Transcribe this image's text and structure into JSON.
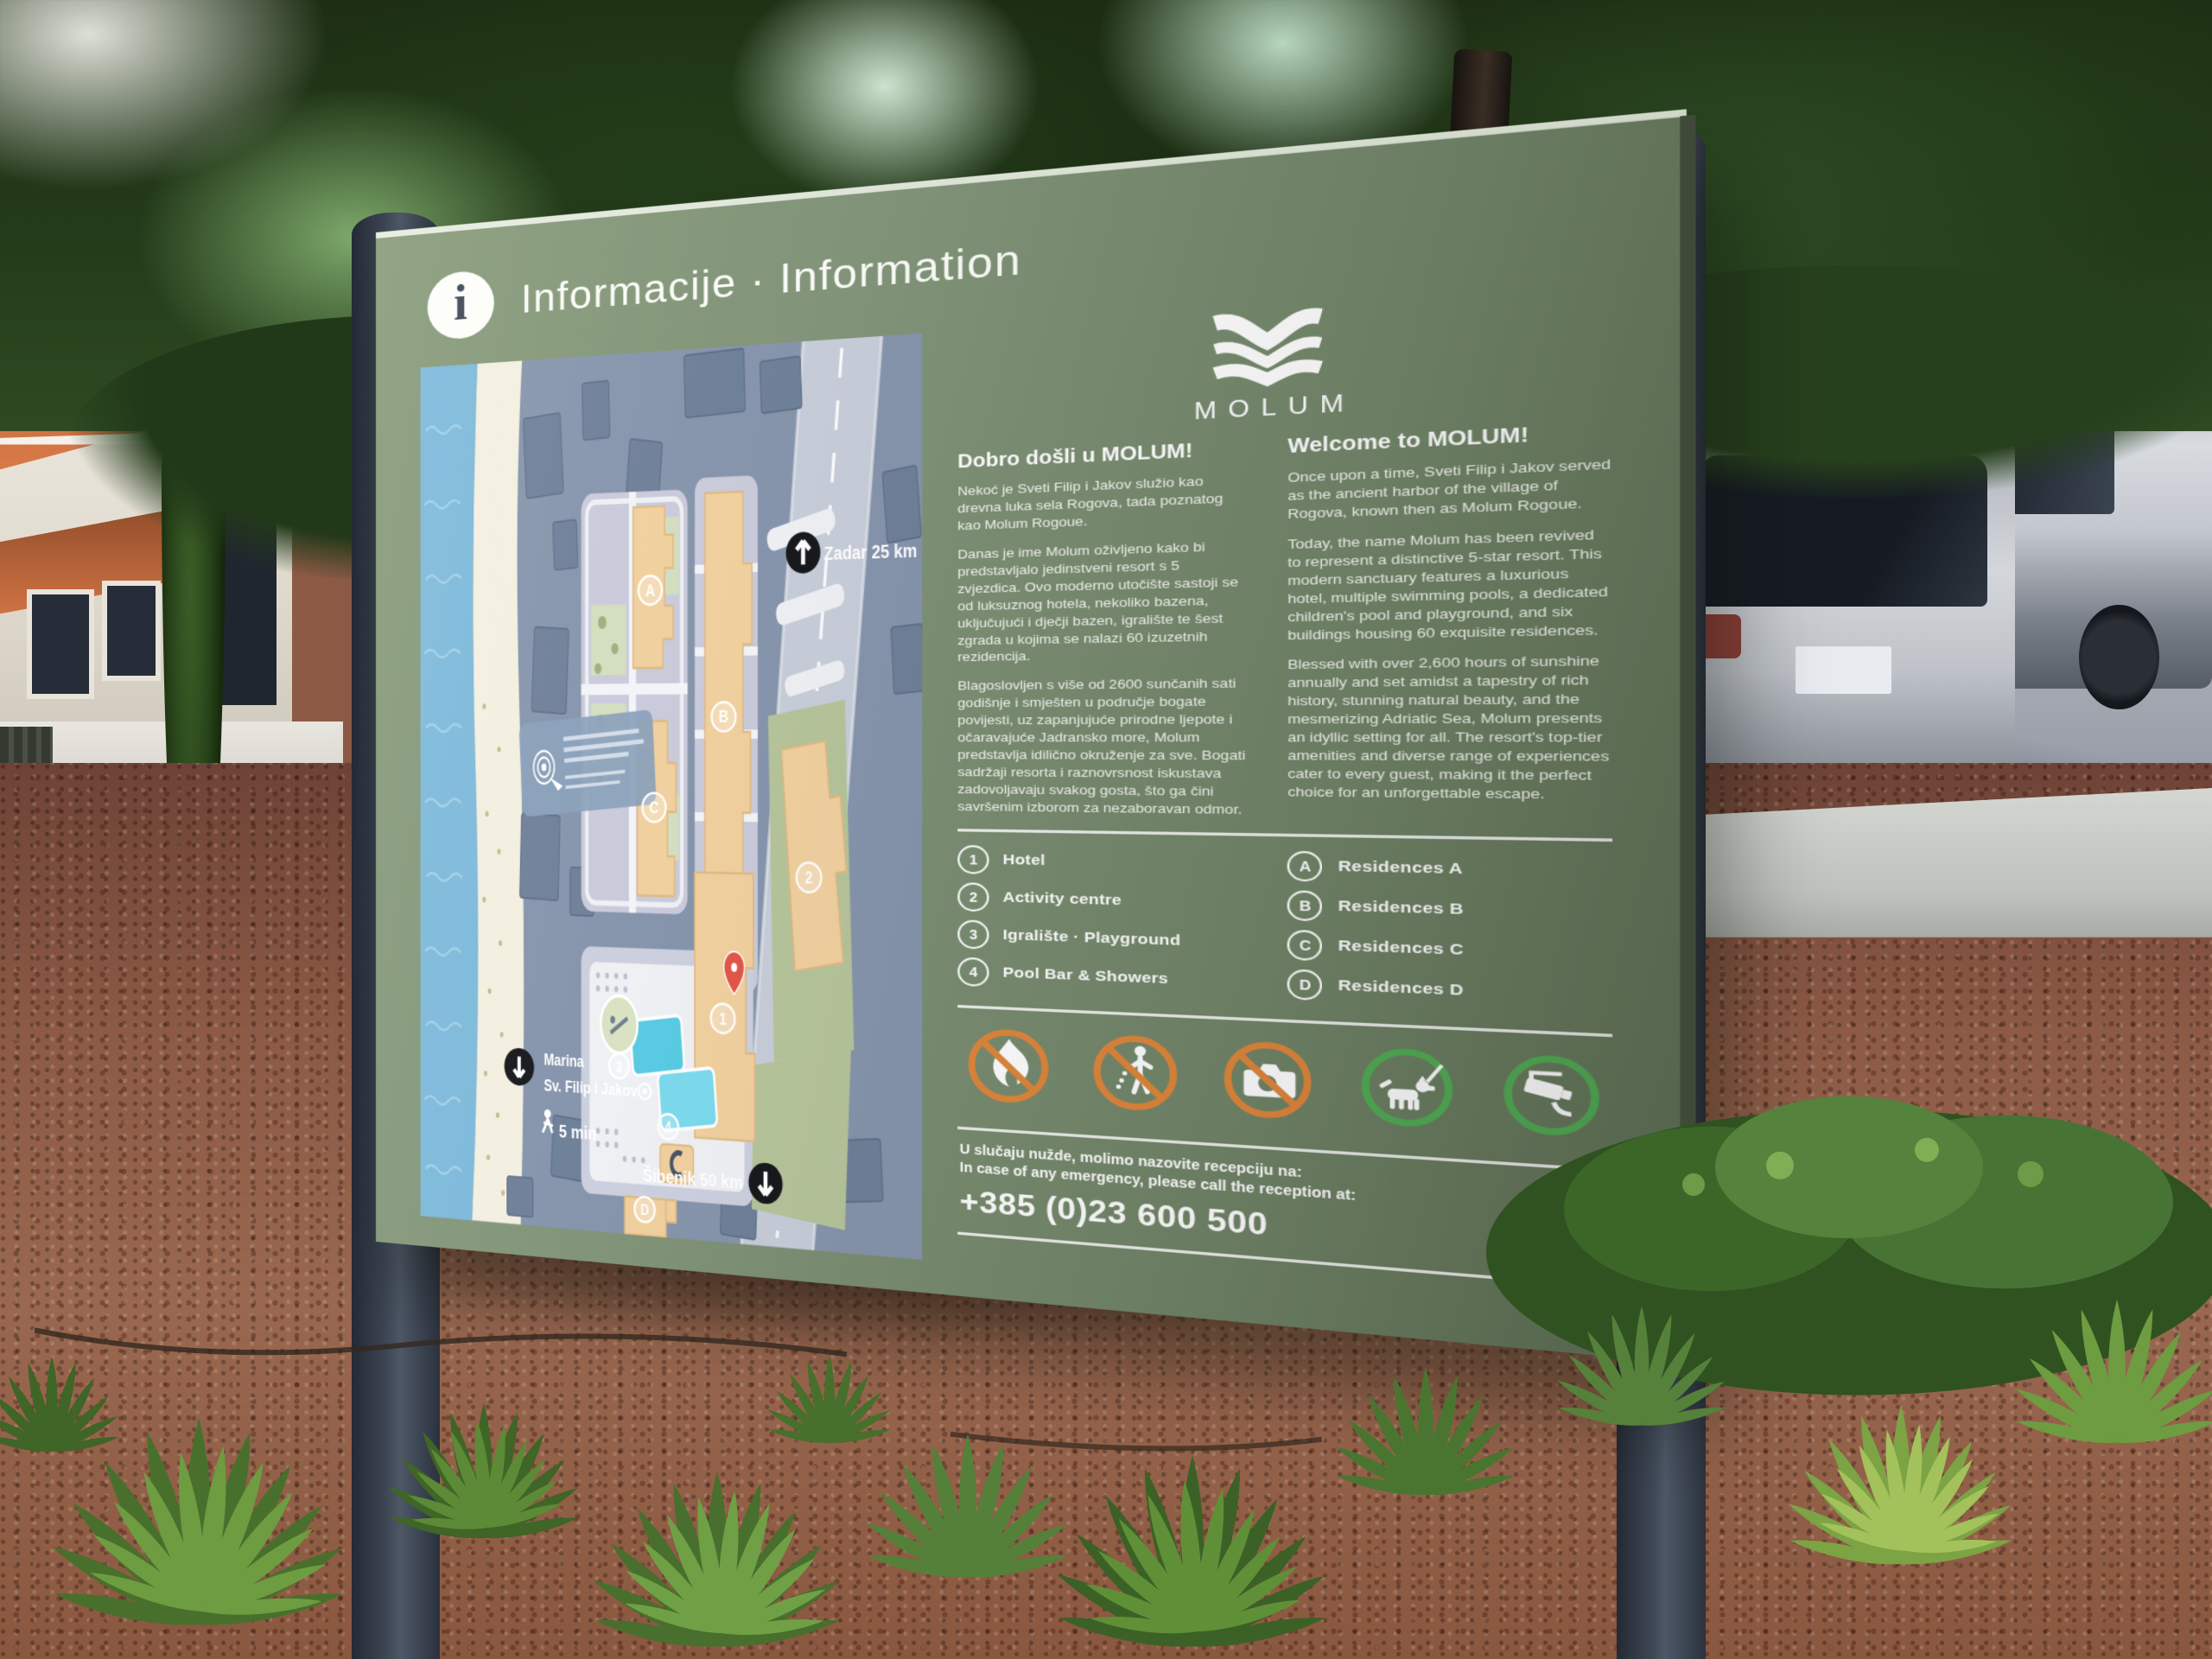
{
  "sign": {
    "header": {
      "title": "Informacije · Information",
      "info_glyph": "i"
    },
    "logo": {
      "wordmark": "MOLUM"
    },
    "columns": {
      "hr": {
        "heading": "Dobro došli u MOLUM!",
        "paragraphs": [
          "Nekoć je Sveti Filip i Jakov služio kao drevna luka sela Rogova, tada poznatog kao Molum Rogoue.",
          "Danas je ime Molum oživljeno kako bi predstavljalo jedinstveni resort s 5 zvjezdica. Ovo moderno utočište sastoji se od luksuznog hotela, nekoliko bazena, uključujući i dječji bazen, igralište te šest zgrada u kojima se nalazi 60 izuzetnih rezidencija.",
          "Blagoslovljen s više od 2600 sunčanih sati godišnje i smješten u područje bogate povijesti, uz zapanjujuće prirodne ljepote i očaravajuće Jadransko more, Molum predstavlja idilično okruženje za sve. Bogati sadržaji resorta i raznovrsnost iskustava zadovoljavaju svakog gosta, što ga čini savršenim izborom za nezaboravan odmor."
        ]
      },
      "en": {
        "heading": "Welcome to MOLUM!",
        "paragraphs": [
          "Once upon a time, Sveti Filip i Jakov served as the ancient harbor of the village of Rogova, known then as Molum Rogoue.",
          "Today, the name Molum has been revived to represent a distinctive 5-star resort. This modern sanctuary features a luxurious hotel, multiple swimming pools, a dedicated children's pool and playground, and six buildings housing 60 exquisite residences.",
          "Blessed with over 2,600 hours of sunshine annually and set amidst a tapestry of rich history, stunning natural beauty, and the mesmerizing Adriatic Sea, Molum presents an idyllic setting for all. The resort's top-tier amenities and diverse range of experiences cater to every guest, making it the perfect choice for an unforgettable escape."
        ]
      }
    },
    "legend": {
      "numbered": [
        {
          "key": "1",
          "label": "Hotel"
        },
        {
          "key": "2",
          "label": "Activity centre"
        },
        {
          "key": "3",
          "label": "Igralište · Playground"
        },
        {
          "key": "4",
          "label": "Pool Bar & Showers"
        }
      ],
      "lettered": [
        {
          "key": "A",
          "label": "Residences A"
        },
        {
          "key": "B",
          "label": "Residences B"
        },
        {
          "key": "C",
          "label": "Residences C"
        },
        {
          "key": "D",
          "label": "Residences D"
        }
      ]
    },
    "pictograms": [
      {
        "name": "no-open-fire",
        "type": "prohibition"
      },
      {
        "name": "no-littering",
        "type": "prohibition"
      },
      {
        "name": "no-photography",
        "type": "prohibition"
      },
      {
        "name": "dogs-on-leash",
        "type": "mandatory"
      },
      {
        "name": "cctv-in-operation",
        "type": "mandatory"
      }
    ],
    "emergency": {
      "line_hr": "U slučaju nužde, molimo nazovite recepciju na:",
      "line_en": "In case of any emergency, please call the reception at:",
      "phone": "+385 (0)23 600 500"
    },
    "map": {
      "labels": {
        "zadar": "Zadar 25 km",
        "sibenik": "Šibenik 50 km",
        "marina_line1": "Marina",
        "marina_line2": "Sv. Filip i Jakov",
        "walk_time": "5 min"
      },
      "badges": {
        "hotel": "1",
        "activity": "2",
        "playground": "3",
        "poolbar": "4",
        "res_a": "A",
        "res_b": "B",
        "res_c": "C",
        "res_d": "D"
      }
    },
    "colors": {
      "panel_green": "#7e9273",
      "prohibition_orange": "#e0873c",
      "mandatory_green": "#53ae57",
      "map_sea": "#7db9da",
      "map_land": "#8695ac",
      "map_building": "#f1d09f"
    }
  }
}
